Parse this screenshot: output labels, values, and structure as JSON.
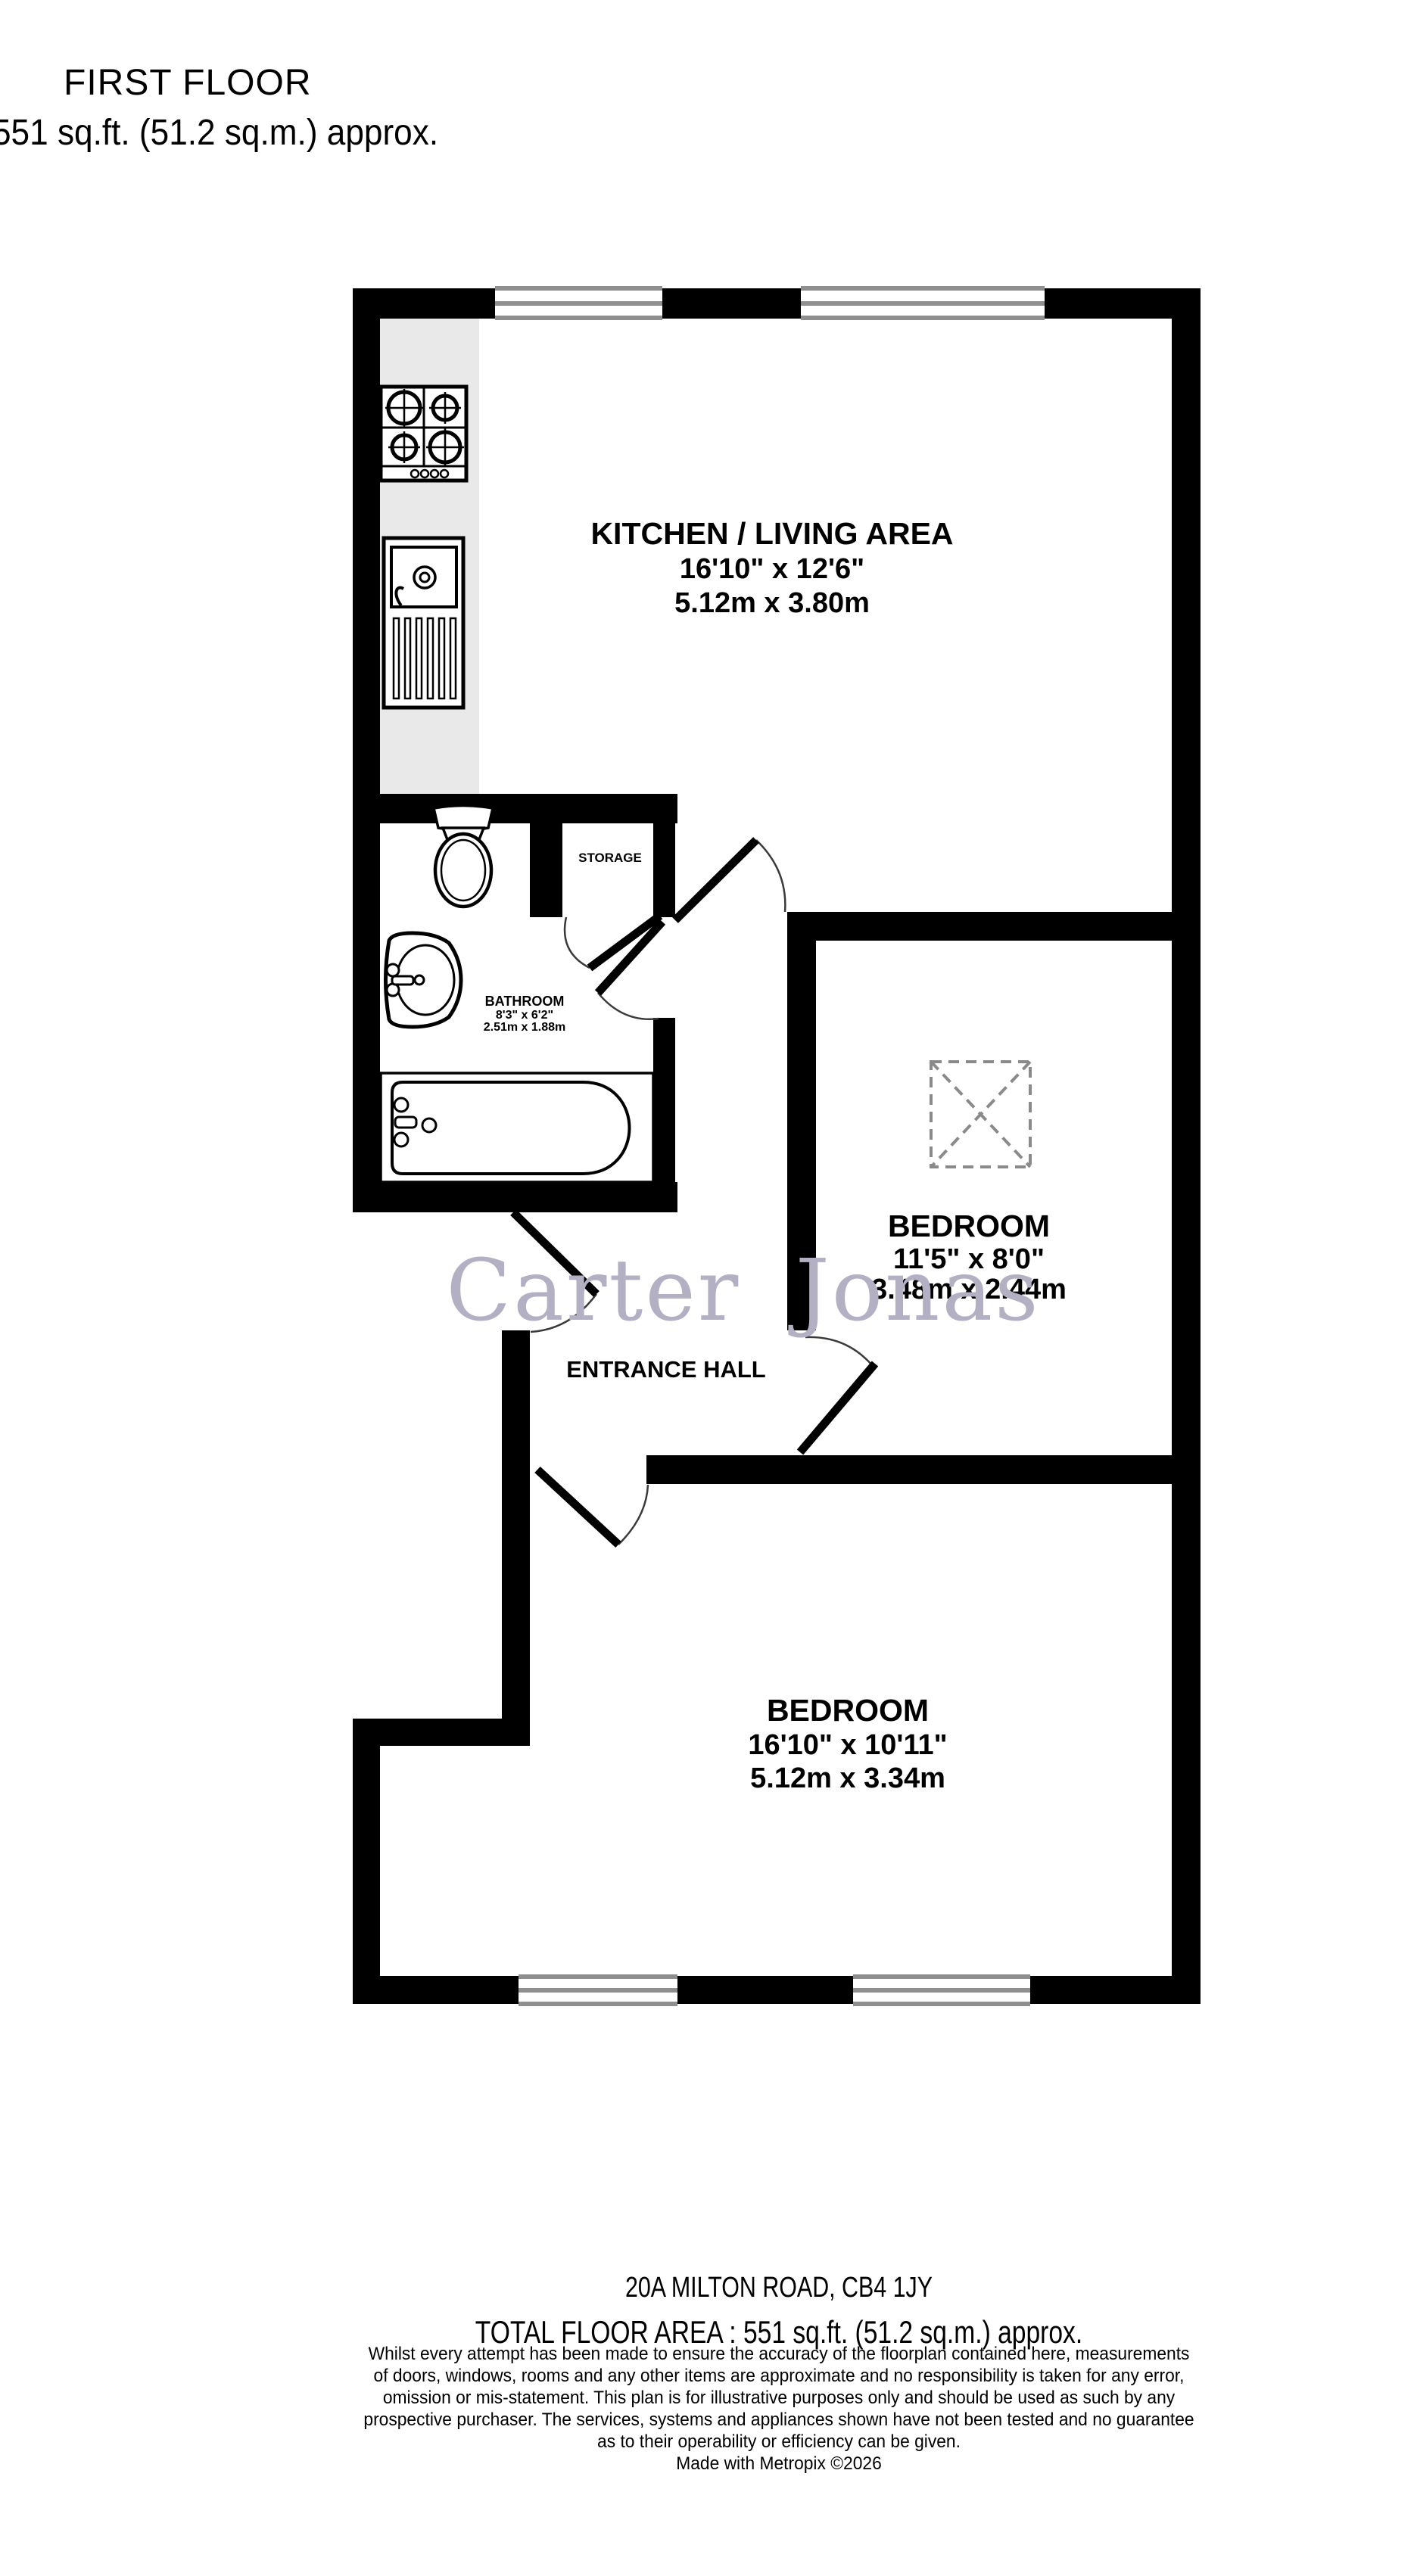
{
  "title": {
    "floor": "FIRST FLOOR",
    "area": "551 sq.ft. (51.2 sq.m.) approx."
  },
  "watermark": "Carter Jonas",
  "rooms": {
    "kitchen": {
      "name": "KITCHEN / LIVING AREA",
      "imperial": "16'10\" x 12'6\"",
      "metric": "5.12m x 3.80m"
    },
    "storage": {
      "name": "STORAGE"
    },
    "bathroom": {
      "name": "BATHROOM",
      "imperial": "8'3\" x 6'2\"",
      "metric": "2.51m x 1.88m"
    },
    "bedroom1": {
      "name": "BEDROOM",
      "imperial": "11'5\" x 8'0\"",
      "metric": "3.48m x 2.44m"
    },
    "hall": {
      "name": "ENTRANCE HALL"
    },
    "bedroom2": {
      "name": "BEDROOM",
      "imperial": "16'10\" x 10'11\"",
      "metric": "5.12m x 3.34m"
    }
  },
  "footer": {
    "address": "20A MILTON ROAD, CB4 1JY",
    "total_area": "TOTAL FLOOR AREA : 551 sq.ft. (51.2 sq.m.) approx.",
    "disclaimer_lines": [
      "Whilst every attempt has been made to ensure the accuracy of the floorplan contained here, measurements",
      "of doors, windows, rooms and any other items are approximate and no responsibility is taken for any error,",
      "omission or mis-statement. This plan is for illustrative purposes only and should be used as such by any",
      "prospective purchaser. The services, systems and appliances shown have not been tested and no guarantee",
      "as to their operability or efficiency can be given."
    ],
    "credit": "Made with Metropix ©2026"
  },
  "colors": {
    "wall": "#000000",
    "window_line": "#8f8f8f",
    "counter": "#e9e9e9",
    "watermark": "#b3b0c4",
    "door_arc": "#3a3a3a",
    "skylight": "#8a8a8a"
  }
}
